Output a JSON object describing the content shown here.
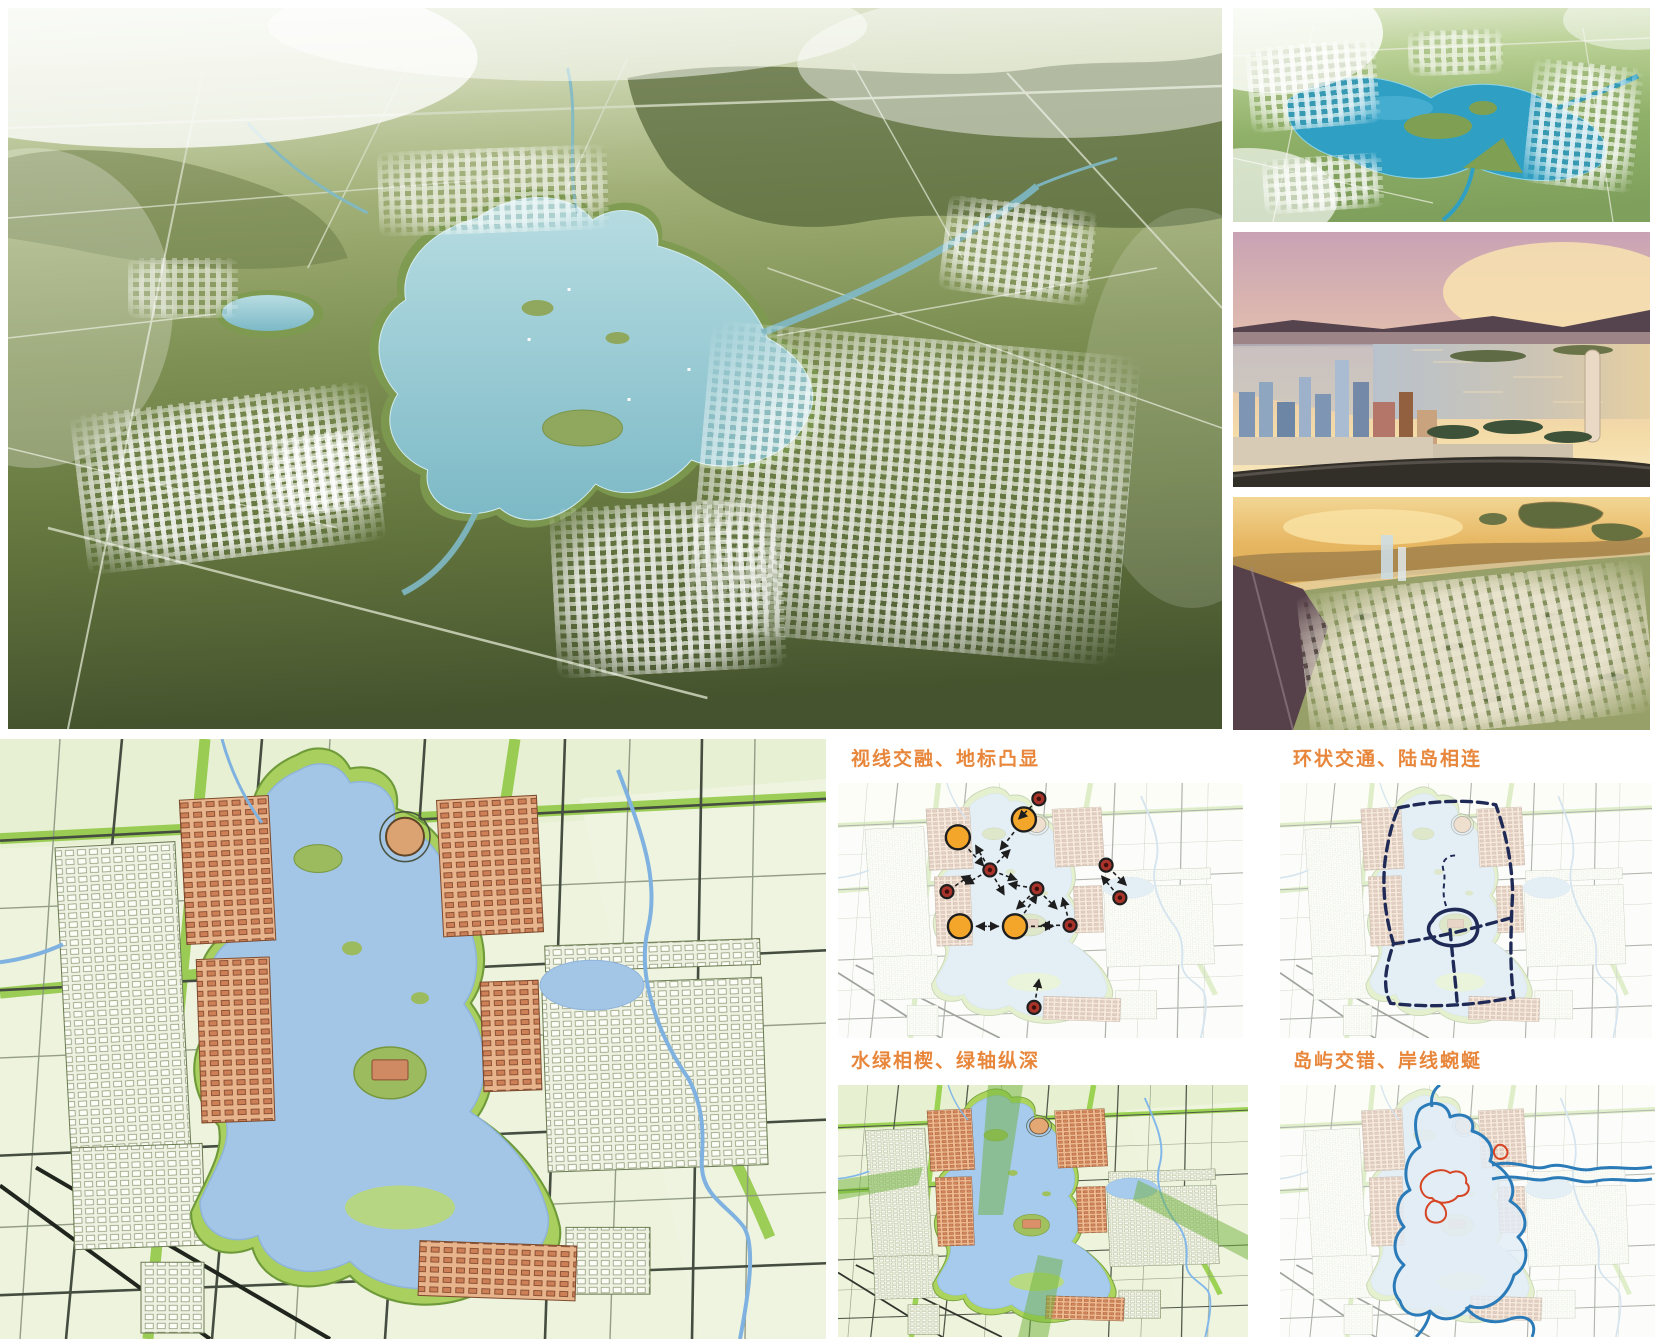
{
  "page": {
    "type": "urban-planning-presentation-board",
    "background": "#ffffff"
  },
  "titles": {
    "sightlines": "视线交融、地标凸显",
    "ring": "环状交通、陆岛相连",
    "green": "水绿相楔、绿轴纵深",
    "islands": "岛屿交错、岸线蜿蜒"
  },
  "colors": {
    "title_text": "#e8873b",
    "landmark_marker": "#f3a62a",
    "viewpoint_marker": "#a8332a",
    "marker_outline": "#1e1e1e",
    "ring_road": "#1f2a56",
    "shoreline": "#2b7bb9",
    "island_outline": "#d64524",
    "lake": "#a3c6e6",
    "park_green": "#8cc63e"
  },
  "diagram_markers": {
    "landmarks": [
      {
        "x": 29.6,
        "y": 21.3,
        "arrows": [
          48
        ]
      },
      {
        "x": 45.9,
        "y": 14.3,
        "arrows": [
          128
        ]
      },
      {
        "x": 30.1,
        "y": 56.2,
        "arrows": [
          0
        ]
      },
      {
        "x": 43.7,
        "y": 56.2,
        "arrows": [
          0,
          180,
          -55
        ]
      }
    ],
    "viewpoints": [
      {
        "x": 49.6,
        "y": 6.2,
        "arrows": [
          135
        ]
      },
      {
        "x": 37.5,
        "y": 34.1,
        "arrows": [
          -45,
          -120,
          20,
          150,
          60
        ]
      },
      {
        "x": 26.9,
        "y": 42.6,
        "arrows": [
          -35
        ]
      },
      {
        "x": 49.1,
        "y": 41.5,
        "arrows": [
          -170,
          135,
          45
        ]
      },
      {
        "x": 57.3,
        "y": 55.8,
        "arrows": [
          180,
          -105
        ]
      },
      {
        "x": 66.2,
        "y": 32.2,
        "arrows": [
          45
        ]
      },
      {
        "x": 69.6,
        "y": 45.0,
        "arrows": [
          -130
        ]
      },
      {
        "x": 48.4,
        "y": 88.0,
        "arrows": [
          -80
        ]
      }
    ]
  },
  "paths": {
    "ring_outer": "M118,25 C152,18 186,16 216,22 C226,50 232,78 233,110 C231,152 230,186 234,216 C196,224 150,227 110,222 C102,207 104,188 113,162 C104,133 101,103 105,74 C108,55 112,38 118,25 Z",
    "ring_cross": "M113,162 C152,157 192,147 231,136",
    "ring_vert": "M170,148 C172,172 175,196 177,220",
    "island_loop": "M152,139 C158,128 176,124 189,131 C199,137 201,151 192,159 C179,167 159,165 152,156 C147,150 147,144 152,139 Z",
    "island_link": "M166,124 C160,108 167,97 163,87 C161,79 167,73 175,73",
    "shoreline": "M140,24 C152,14 168,18 170,32 C184,26 196,34 192,46 C206,50 216,62 210,76 C228,86 238,102 230,116 C246,126 250,142 238,152 C250,164 248,182 234,190 C228,212 208,228 190,221 C178,236 160,238 150,226 C138,234 124,230 120,216 C110,205 114,190 124,180 C112,170 112,152 124,142 C114,130 116,112 130,105 C122,90 126,70 140,62 C134,46 134,32 140,24 Z",
    "shore_arm1": "M212,80 C238,74 252,86 266,82 C284,76 296,88 314,84 C334,80 350,86 372,82",
    "shore_arm2": "M212,94 C240,88 254,98 268,94 C286,89 298,100 316,96 C336,92 352,98 372,94",
    "shore_river1": "M186,222 C196,236 214,240 230,234 C248,228 258,238 252,252",
    "shore_river2": "M150,227 C148,238 142,246 136,252",
    "shore_inlet": "M152,22 C150,12 154,4 160,0",
    "islands": [
      "M142,96 C148,86 162,82 170,88 C178,84 188,88 186,98 C192,102 188,112 178,111 C172,119 158,120 152,113 C144,114 138,104 142,96 Z",
      "M150,118 C144,124 144,134 152,137 C162,140 170,132 164,122 C160,116 154,114 150,118 Z",
      "M216,62 C212,66 214,73 220,74 C227,74 230,67 225,62 C222,59 218,59 216,62 Z"
    ]
  }
}
